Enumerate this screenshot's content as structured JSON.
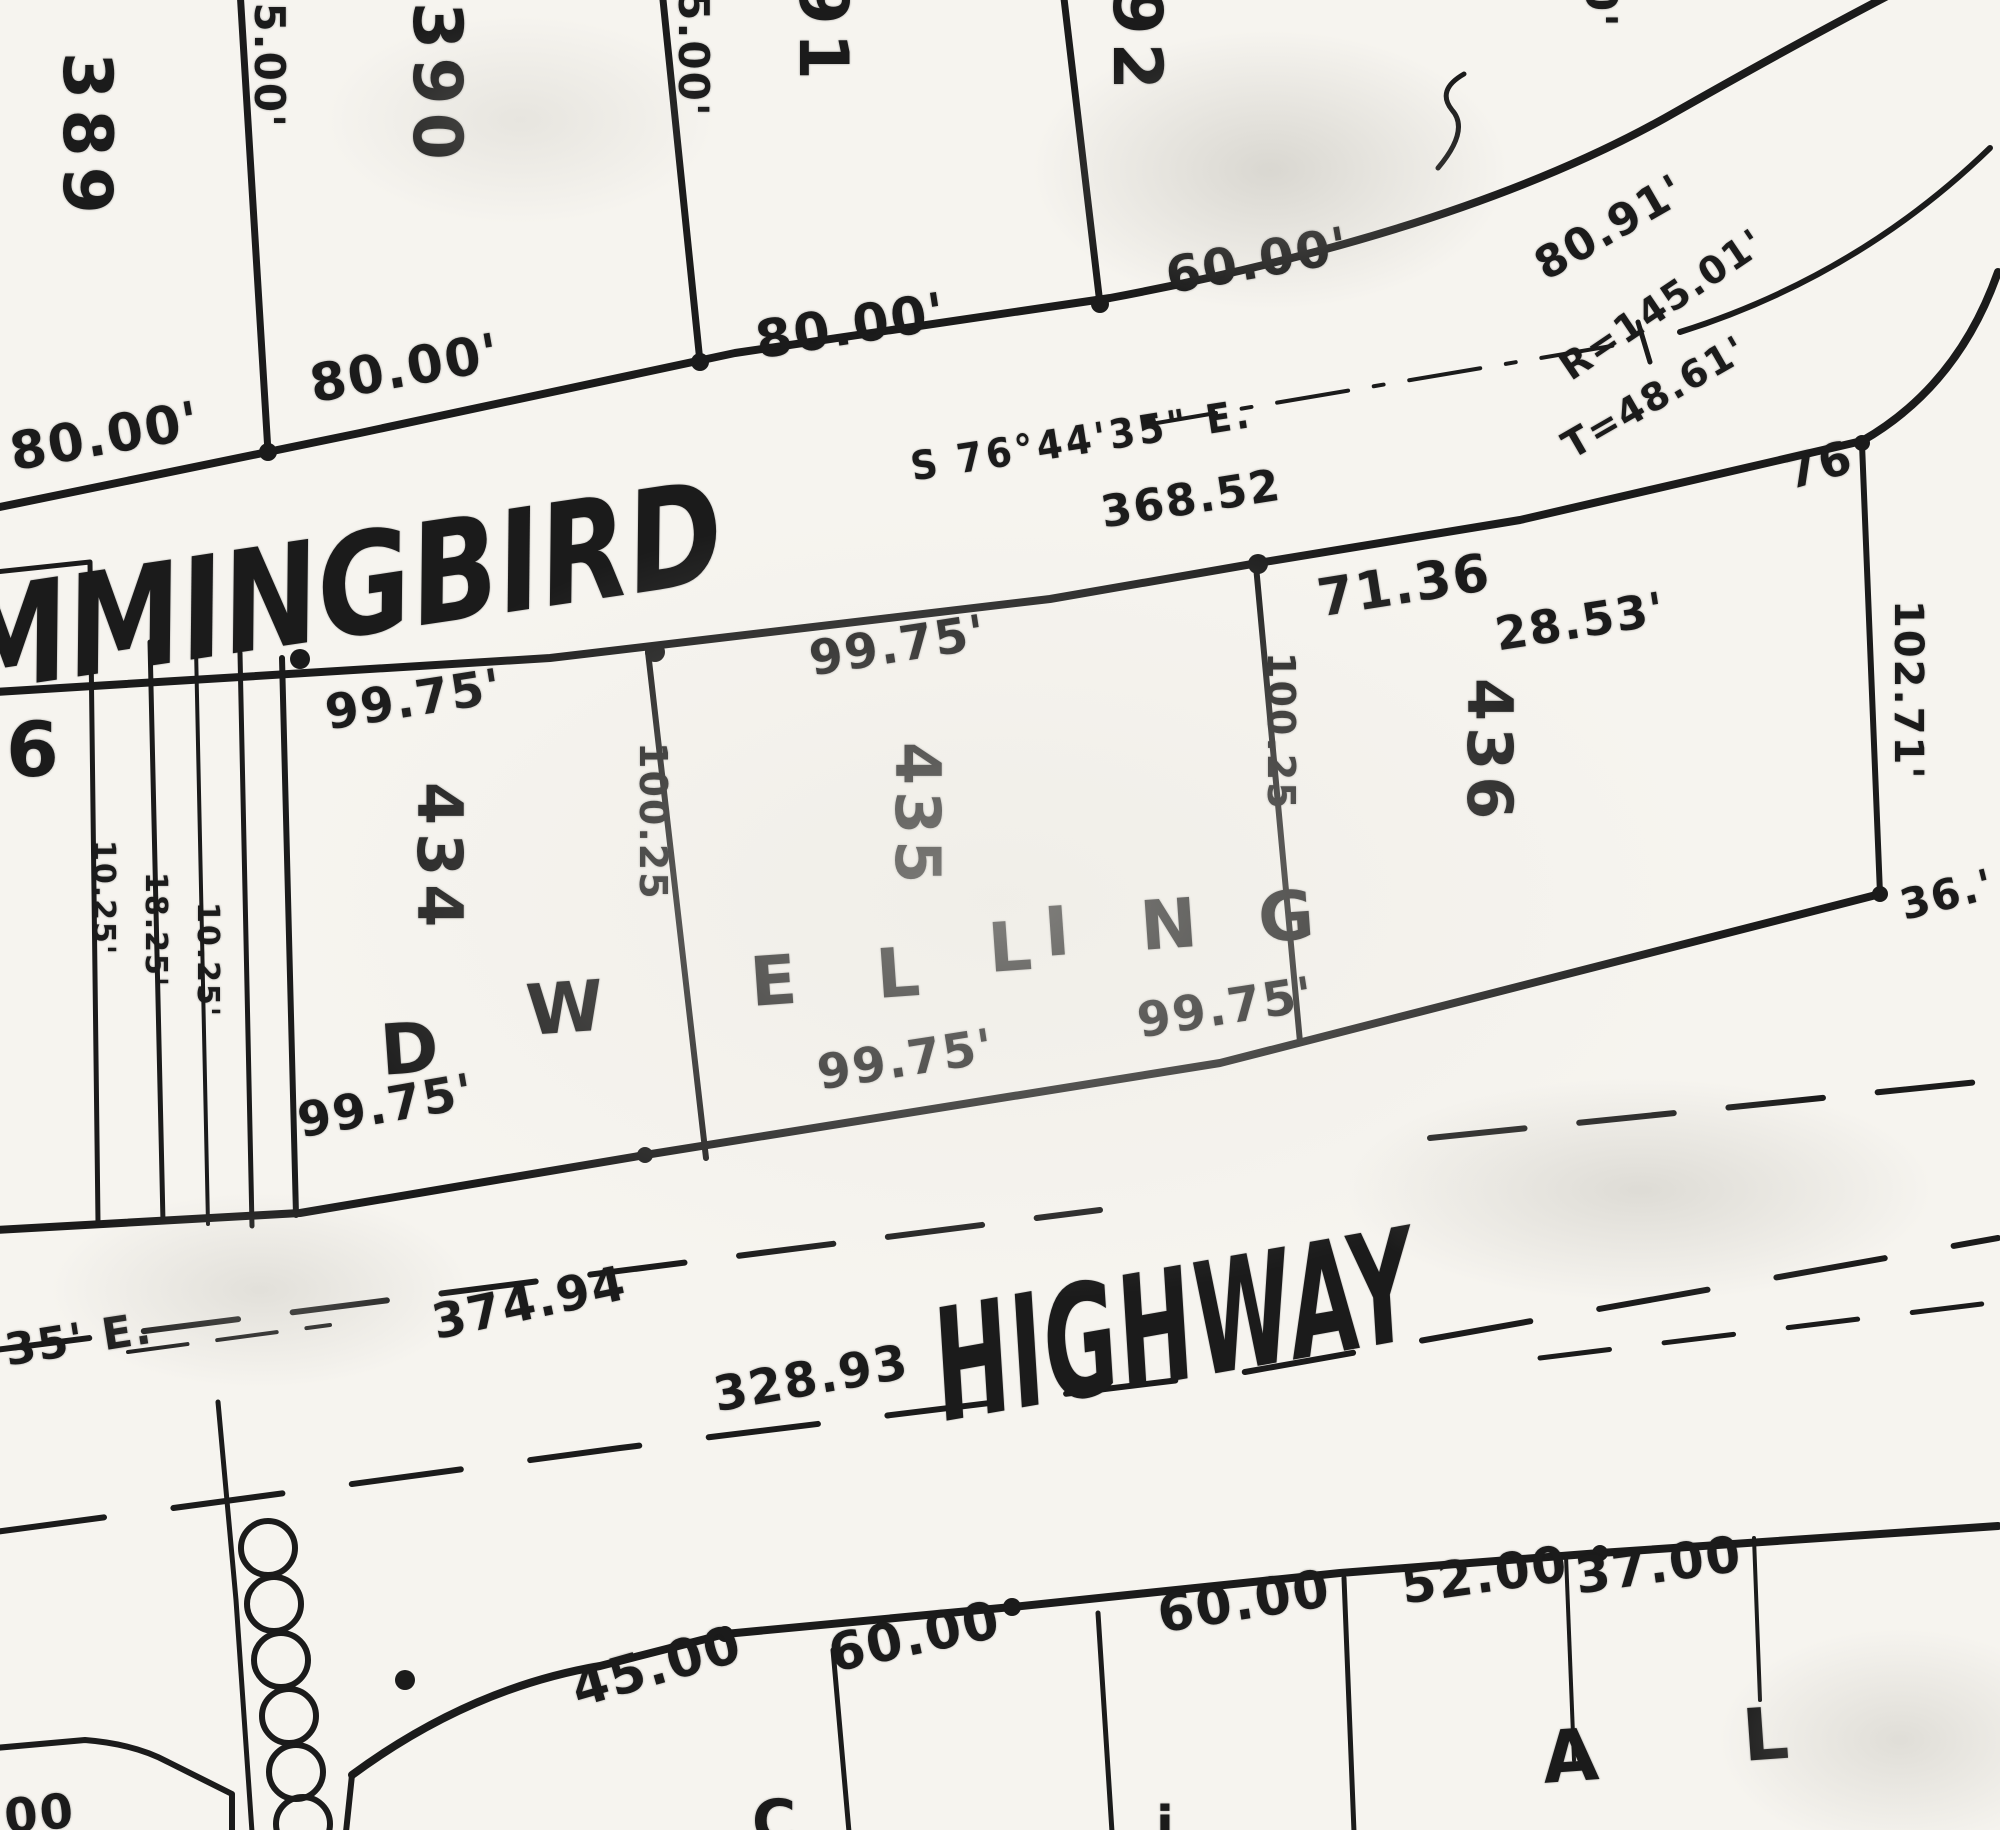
{
  "colors": {
    "ink": "#1b1b1b",
    "paper": "#f6f4ef"
  },
  "street": {
    "name_fragment": "MMINGBIRD",
    "bearing": "S 76°44'35\" E.",
    "distance": "368.52"
  },
  "highway": {
    "name": "HIGHWAY",
    "bearing_fragment": "35' E.",
    "distance_a": "374.94",
    "distance_b": "328.93"
  },
  "curve_notes": {
    "arc": "80.91'",
    "radius": "R=145.01'",
    "tangent": "T=48.61'",
    "offset": "76"
  },
  "top_lots": {
    "lot1": "389",
    "lot2": "390",
    "lot3": "391",
    "lot4": "392",
    "depth_a": "125.00'",
    "depth_b": "25.00'",
    "front_a": "80.00'",
    "front_b": "80.00'",
    "front_c": "80.00'",
    "front_d": "60.00'",
    "edge_fragment": "00'"
  },
  "mid_lots": {
    "lot_a": "434",
    "lot_b": "435",
    "lot_c": "436",
    "partial_lot": "6",
    "strip_dims": [
      "10.25'",
      "18.25'",
      "10.25'"
    ],
    "front_434": "99.75'",
    "rear_434": "99.75'",
    "front_435": "99.75'",
    "rear_435": "99.75'",
    "front_436": "71.36",
    "front_436b": "28.53'",
    "rear_436": "99.75'",
    "side_ab": "100.25",
    "side_bc": "100.25",
    "side_east": "102.71'",
    "fragment_36": "36.'",
    "dwelling": [
      "D",
      "W",
      "E",
      "L",
      "L",
      "I",
      "N",
      "G"
    ]
  },
  "bottom_lots": {
    "front_a": "45.00",
    "front_b": "60.00",
    "front_c": "60.00",
    "front_d": "52.00",
    "front_e": "37.00",
    "letter_a": "A",
    "letter_b": "L",
    "fragment_c": "C",
    "fragment_i": "i.",
    "fragment_00": "00"
  }
}
